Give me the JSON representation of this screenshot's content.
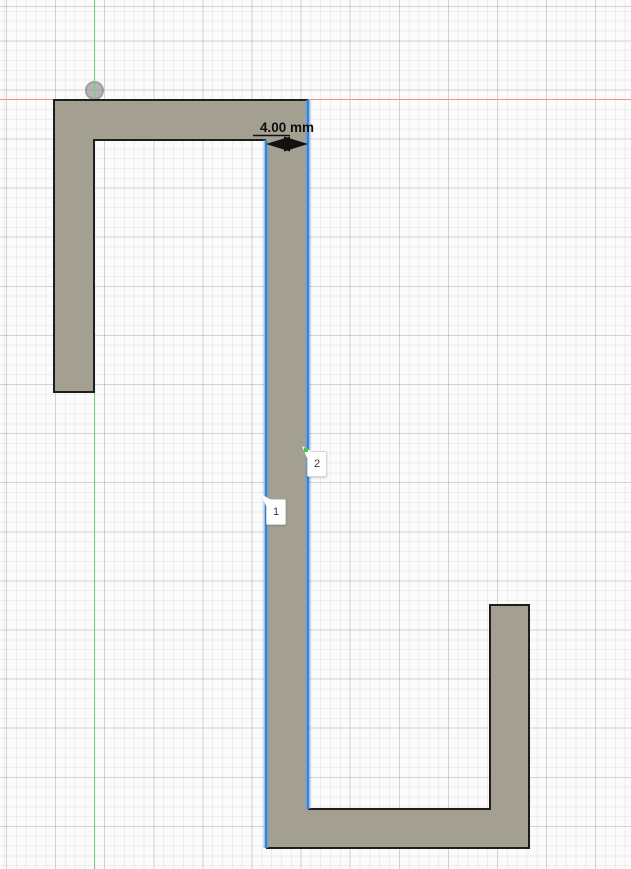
{
  "canvas": {
    "width": 631,
    "height": 869,
    "description": "CAD sketch canvas with grid and origin axes"
  },
  "dimension": {
    "value": "4.00 mm"
  },
  "selection_tags": [
    {
      "label": "1"
    },
    {
      "label": "2"
    }
  ],
  "colors": {
    "canvas_bg": "#fbfbfb",
    "grid_minor": "rgba(0,0,0,0.05)",
    "grid_major": "rgba(0,0,0,0.115)",
    "axis_x": "#f28f8f",
    "axis_y": "#76d26d",
    "profile_fill": "#a4a091",
    "edge": "#1d1d1b",
    "selection": "#2f86dc",
    "selection_halo": "rgba(111,166,227,0.45)",
    "midpoint_green": "#44cb47",
    "origin_gray": "rgba(125,125,125,0.55)"
  }
}
